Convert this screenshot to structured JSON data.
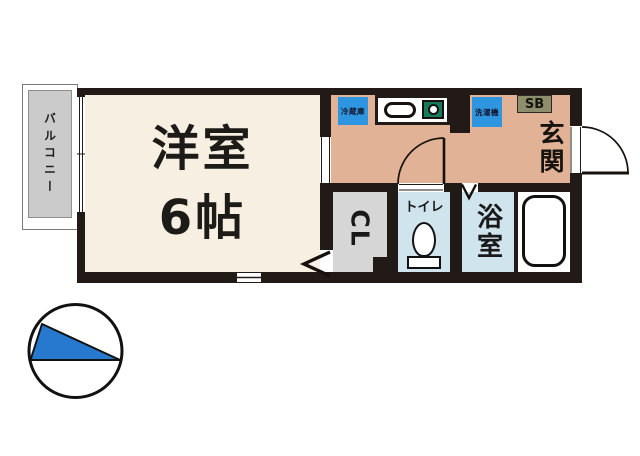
{
  "floor_plan": {
    "balcony": {
      "label": "バルコニー"
    },
    "western_room": {
      "label": "洋室",
      "size": "6帖"
    },
    "kitchen": {
      "refrigerator_label": "冷蔵庫",
      "washing_machine_label": "洗濯機"
    },
    "entrance": {
      "label": "玄関",
      "shoe_box_label": "SB"
    },
    "closet": {
      "label": "CL"
    },
    "toilet": {
      "label": "トイレ"
    },
    "bathroom": {
      "label": "浴室"
    }
  },
  "icons": {
    "compass": "north-compass-icon",
    "bathtub": "bathtub-icon",
    "toilet": "toilet-icon",
    "kitchen_sink": "kitchen-sink-icon",
    "stove_burner": "stove-burner-icon",
    "door_swing": "door-swing-arc-icon",
    "folding_door": "folding-door-chevron-icon",
    "sliding_window": "sliding-window-icon"
  },
  "colors": {
    "wall": "#221a16",
    "western_room_floor": "#f7f0e2",
    "kitchen_floor": "#e2b296",
    "wet_room_floor": "#cfe4ed",
    "closet_floor": "#d6d6d6",
    "balcony_gray": "#cbcbcb",
    "appliance_blue": "#2e96e0",
    "stove_green": "#15795b",
    "shoe_box_olive": "#8d8e6d",
    "compass_blue": "#2679cf",
    "line_black": "#111111",
    "background": "#ffffff"
  }
}
